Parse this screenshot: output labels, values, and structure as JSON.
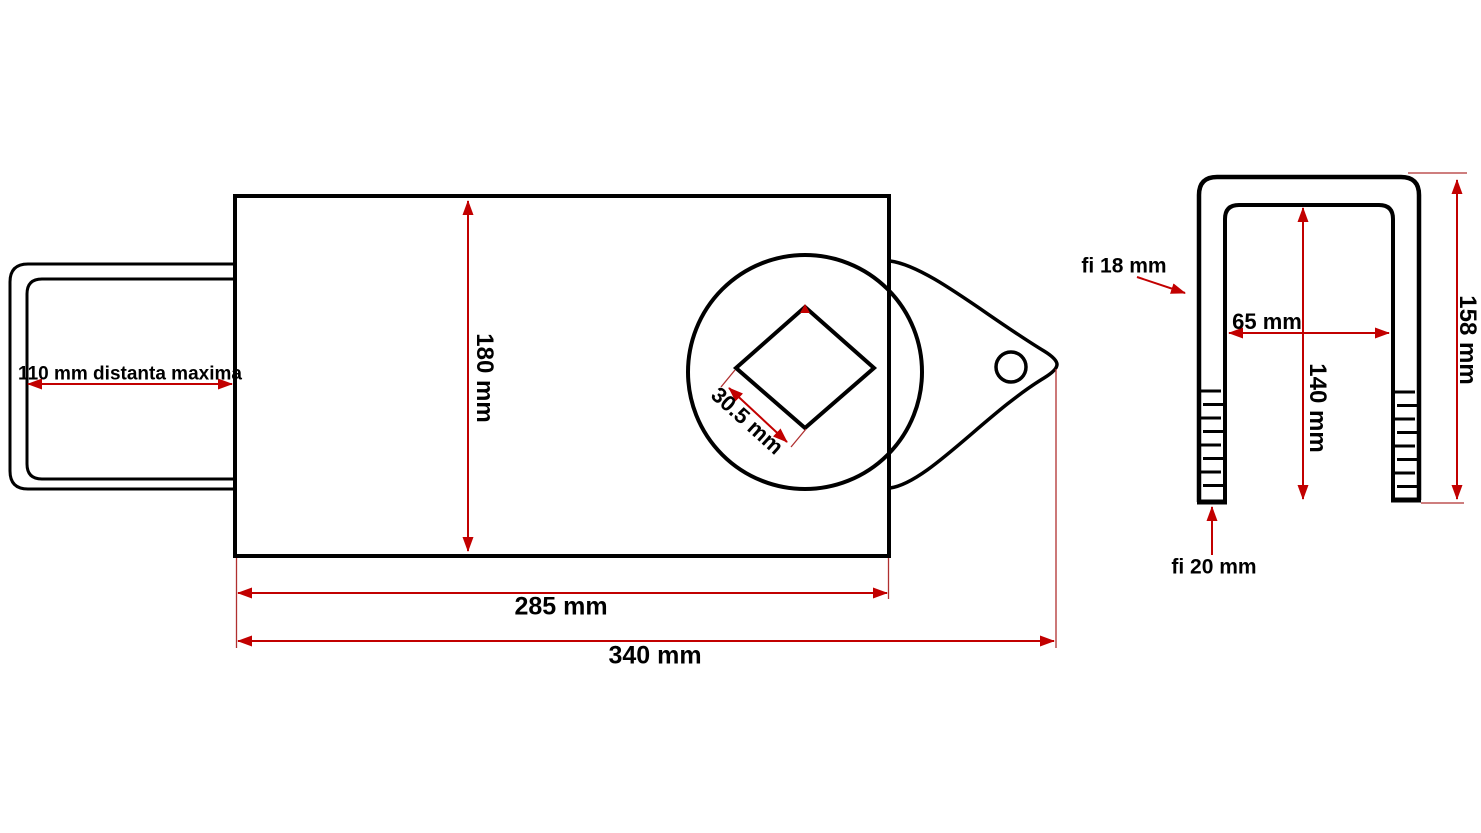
{
  "drawing": {
    "top_view": {
      "dim_distanta_maxima": "110 mm distanta maxima",
      "dim_body_height": "180 mm",
      "dim_square_hole": "30.5 mm",
      "dim_body_length": "285 mm",
      "dim_total_length": "340 mm"
    },
    "u_bolt_view": {
      "dim_rod_diameter": "fi 18 mm",
      "dim_inner_width": "65 mm",
      "dim_inner_depth": "140 mm",
      "dim_total_height": "158 mm",
      "dim_thread_diameter": "fi 20 mm"
    },
    "colors": {
      "line_color": "#000000",
      "dimension_color": "#c20000",
      "extension_color": "#b03030",
      "background": "#ffffff"
    }
  }
}
